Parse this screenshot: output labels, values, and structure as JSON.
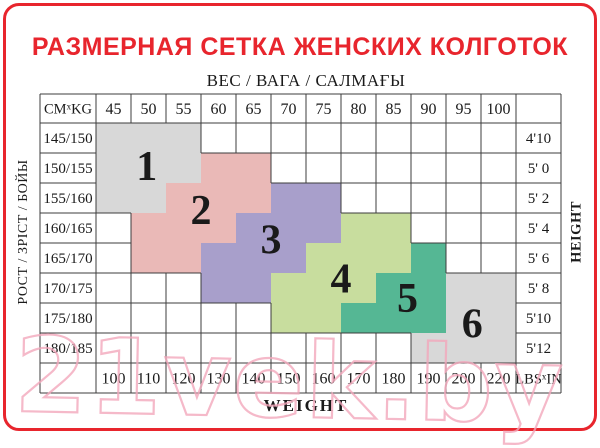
{
  "title": "РАЗМЕРНАЯ СЕТКА ЖЕНСКИХ КОЛГОТОК",
  "watermark": "21vek.by",
  "colors": {
    "accent_red": "#e8252d",
    "grid_line": "#3c3c3c",
    "text": "#1a1a1a",
    "watermark_pink": "#f3a7bb",
    "size_gray": "#d8d8d8",
    "size_pink": "#eab9b7",
    "size_purple": "#a89fcb",
    "size_green": "#c8dd9e",
    "size_teal": "#55b794"
  },
  "chart_data": {
    "type": "table",
    "title": "РАЗМЕРНАЯ СЕТКА ЖЕНСКИХ КОЛГОТОК",
    "top_axis_label": "ВЕС / ВАГА / САЛМАҒЫ",
    "bottom_axis_label": "WEIGHT",
    "left_axis_label": "РОСТ / ЗРІСТ / БОЙЫ",
    "right_axis_label": "HEIGHT",
    "corner_top_left": {
      "main": "CM",
      "sup": "x",
      "rest": "KG"
    },
    "corner_bottom_right": {
      "main": "LBS",
      "sup": "x",
      "rest": "IN"
    },
    "weight_kg": [
      "45",
      "50",
      "55",
      "60",
      "65",
      "70",
      "75",
      "80",
      "85",
      "90",
      "95",
      "100"
    ],
    "weight_lbs": [
      "100",
      "110",
      "120",
      "130",
      "140",
      "150",
      "160",
      "170",
      "180",
      "190",
      "200",
      "220"
    ],
    "height_cm": [
      "145/150",
      "150/155",
      "155/160",
      "160/165",
      "165/170",
      "170/175",
      "175/180",
      "180/185"
    ],
    "height_ft": [
      "4'10",
      "5' 0",
      "5' 2",
      "5' 4",
      "5' 6",
      "5' 8",
      "5'10",
      "5'12"
    ],
    "sizes": [
      {
        "label": "1",
        "color": "#d8d8d8",
        "cells": [
          [
            0,
            0,
            2
          ],
          [
            1,
            0,
            2
          ],
          [
            2,
            0,
            1
          ]
        ],
        "label_pos": [
          1.45,
          1.4
        ]
      },
      {
        "label": "2",
        "color": "#eab9b7",
        "cells": [
          [
            1,
            3,
            4
          ],
          [
            2,
            2,
            4
          ],
          [
            3,
            1,
            3
          ],
          [
            4,
            1,
            2
          ]
        ],
        "label_pos": [
          3.0,
          2.87
        ]
      },
      {
        "label": "3",
        "color": "#a89fcb",
        "cells": [
          [
            2,
            5,
            6
          ],
          [
            3,
            4,
            6
          ],
          [
            4,
            3,
            5
          ],
          [
            5,
            3,
            4
          ]
        ],
        "label_pos": [
          5.0,
          3.85
        ]
      },
      {
        "label": "4",
        "color": "#c8dd9e",
        "cells": [
          [
            3,
            7,
            8
          ],
          [
            4,
            6,
            8
          ],
          [
            5,
            5,
            7
          ],
          [
            6,
            5,
            6
          ]
        ],
        "label_pos": [
          7.0,
          5.15
        ]
      },
      {
        "label": "5",
        "color": "#55b794",
        "cells": [
          [
            4,
            9,
            9
          ],
          [
            5,
            8,
            9
          ],
          [
            6,
            7,
            9
          ]
        ],
        "label_pos": [
          8.9,
          5.8
        ]
      },
      {
        "label": "6",
        "color": "#d8d8d8",
        "cells": [
          [
            5,
            10,
            11
          ],
          [
            6,
            10,
            11
          ],
          [
            7,
            9,
            11
          ]
        ],
        "label_pos": [
          10.75,
          6.65
        ]
      }
    ]
  }
}
